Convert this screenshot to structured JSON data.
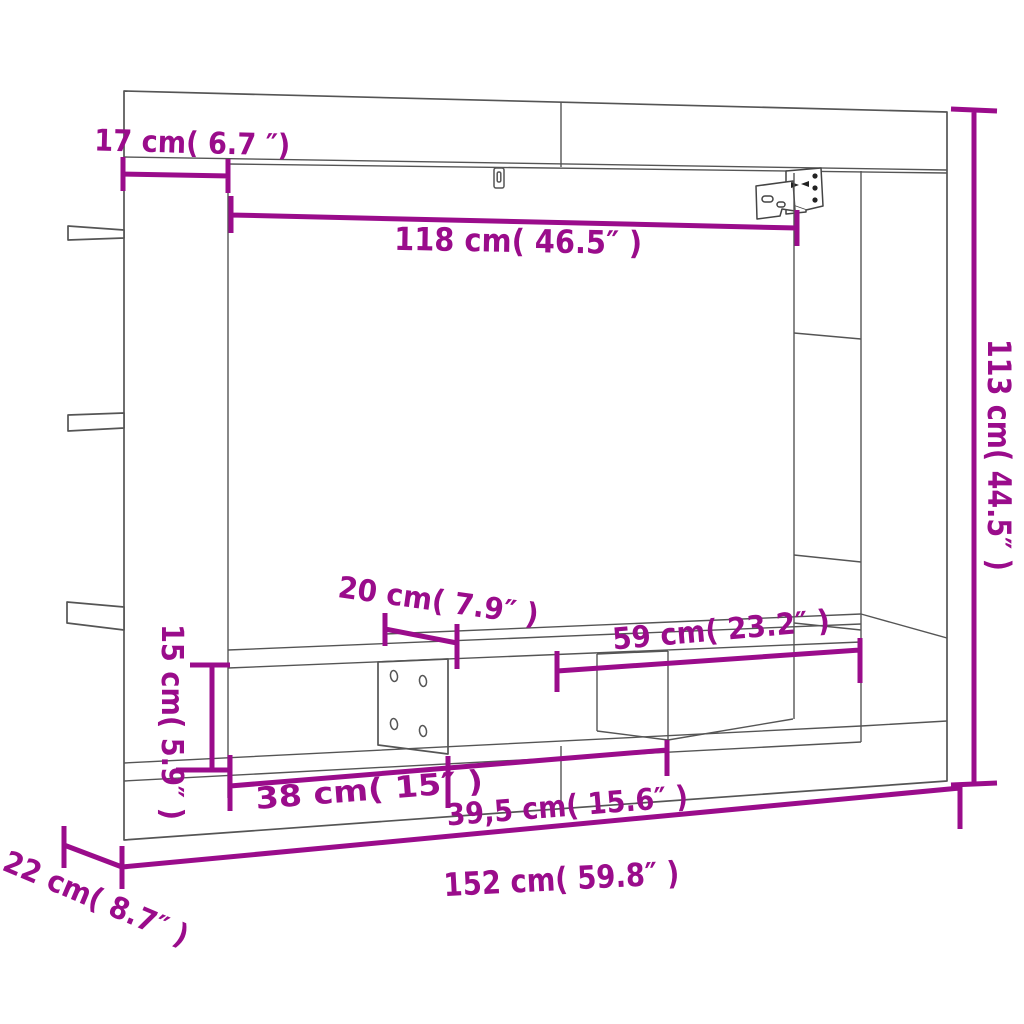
{
  "diagram": {
    "title": "TV wall unit dimension diagram",
    "style": {
      "dimension_color": "#9A0C8B",
      "outline_color": "#555555",
      "background": "#FFFFFF"
    },
    "dimensions": {
      "side_panel_width": {
        "label": "17 cm( 6.7 ″)",
        "cm": 17,
        "inch": 6.7
      },
      "inner_width": {
        "label": "118 cm( 46.5″ )",
        "cm": 118,
        "inch": 46.5
      },
      "total_height": {
        "label": "113 cm( 44.5″ )",
        "cm": 113,
        "inch": 44.5
      },
      "tv_shelf_depth": {
        "label": "20 cm( 7.9″ )",
        "cm": 20,
        "inch": 7.9
      },
      "right_opening_width": {
        "label": "59 cm( 23.2″ )",
        "cm": 59,
        "inch": 23.2
      },
      "shelf_opening_height": {
        "label": "15 cm( 5.9″ )",
        "cm": 15,
        "inch": 5.9
      },
      "left_compartment_width": {
        "label": "38 cm( 15″ )",
        "cm": 38,
        "inch": 15
      },
      "middle_compartment_width": {
        "label": "39,5 cm( 15.6″ )",
        "cm": 39.5,
        "inch": 15.6
      },
      "total_width": {
        "label": "152 cm( 59.8″ )",
        "cm": 152,
        "inch": 59.8
      },
      "base_depth": {
        "label": "22 cm( 8.7″ )",
        "cm": 22,
        "inch": 8.7
      }
    }
  }
}
